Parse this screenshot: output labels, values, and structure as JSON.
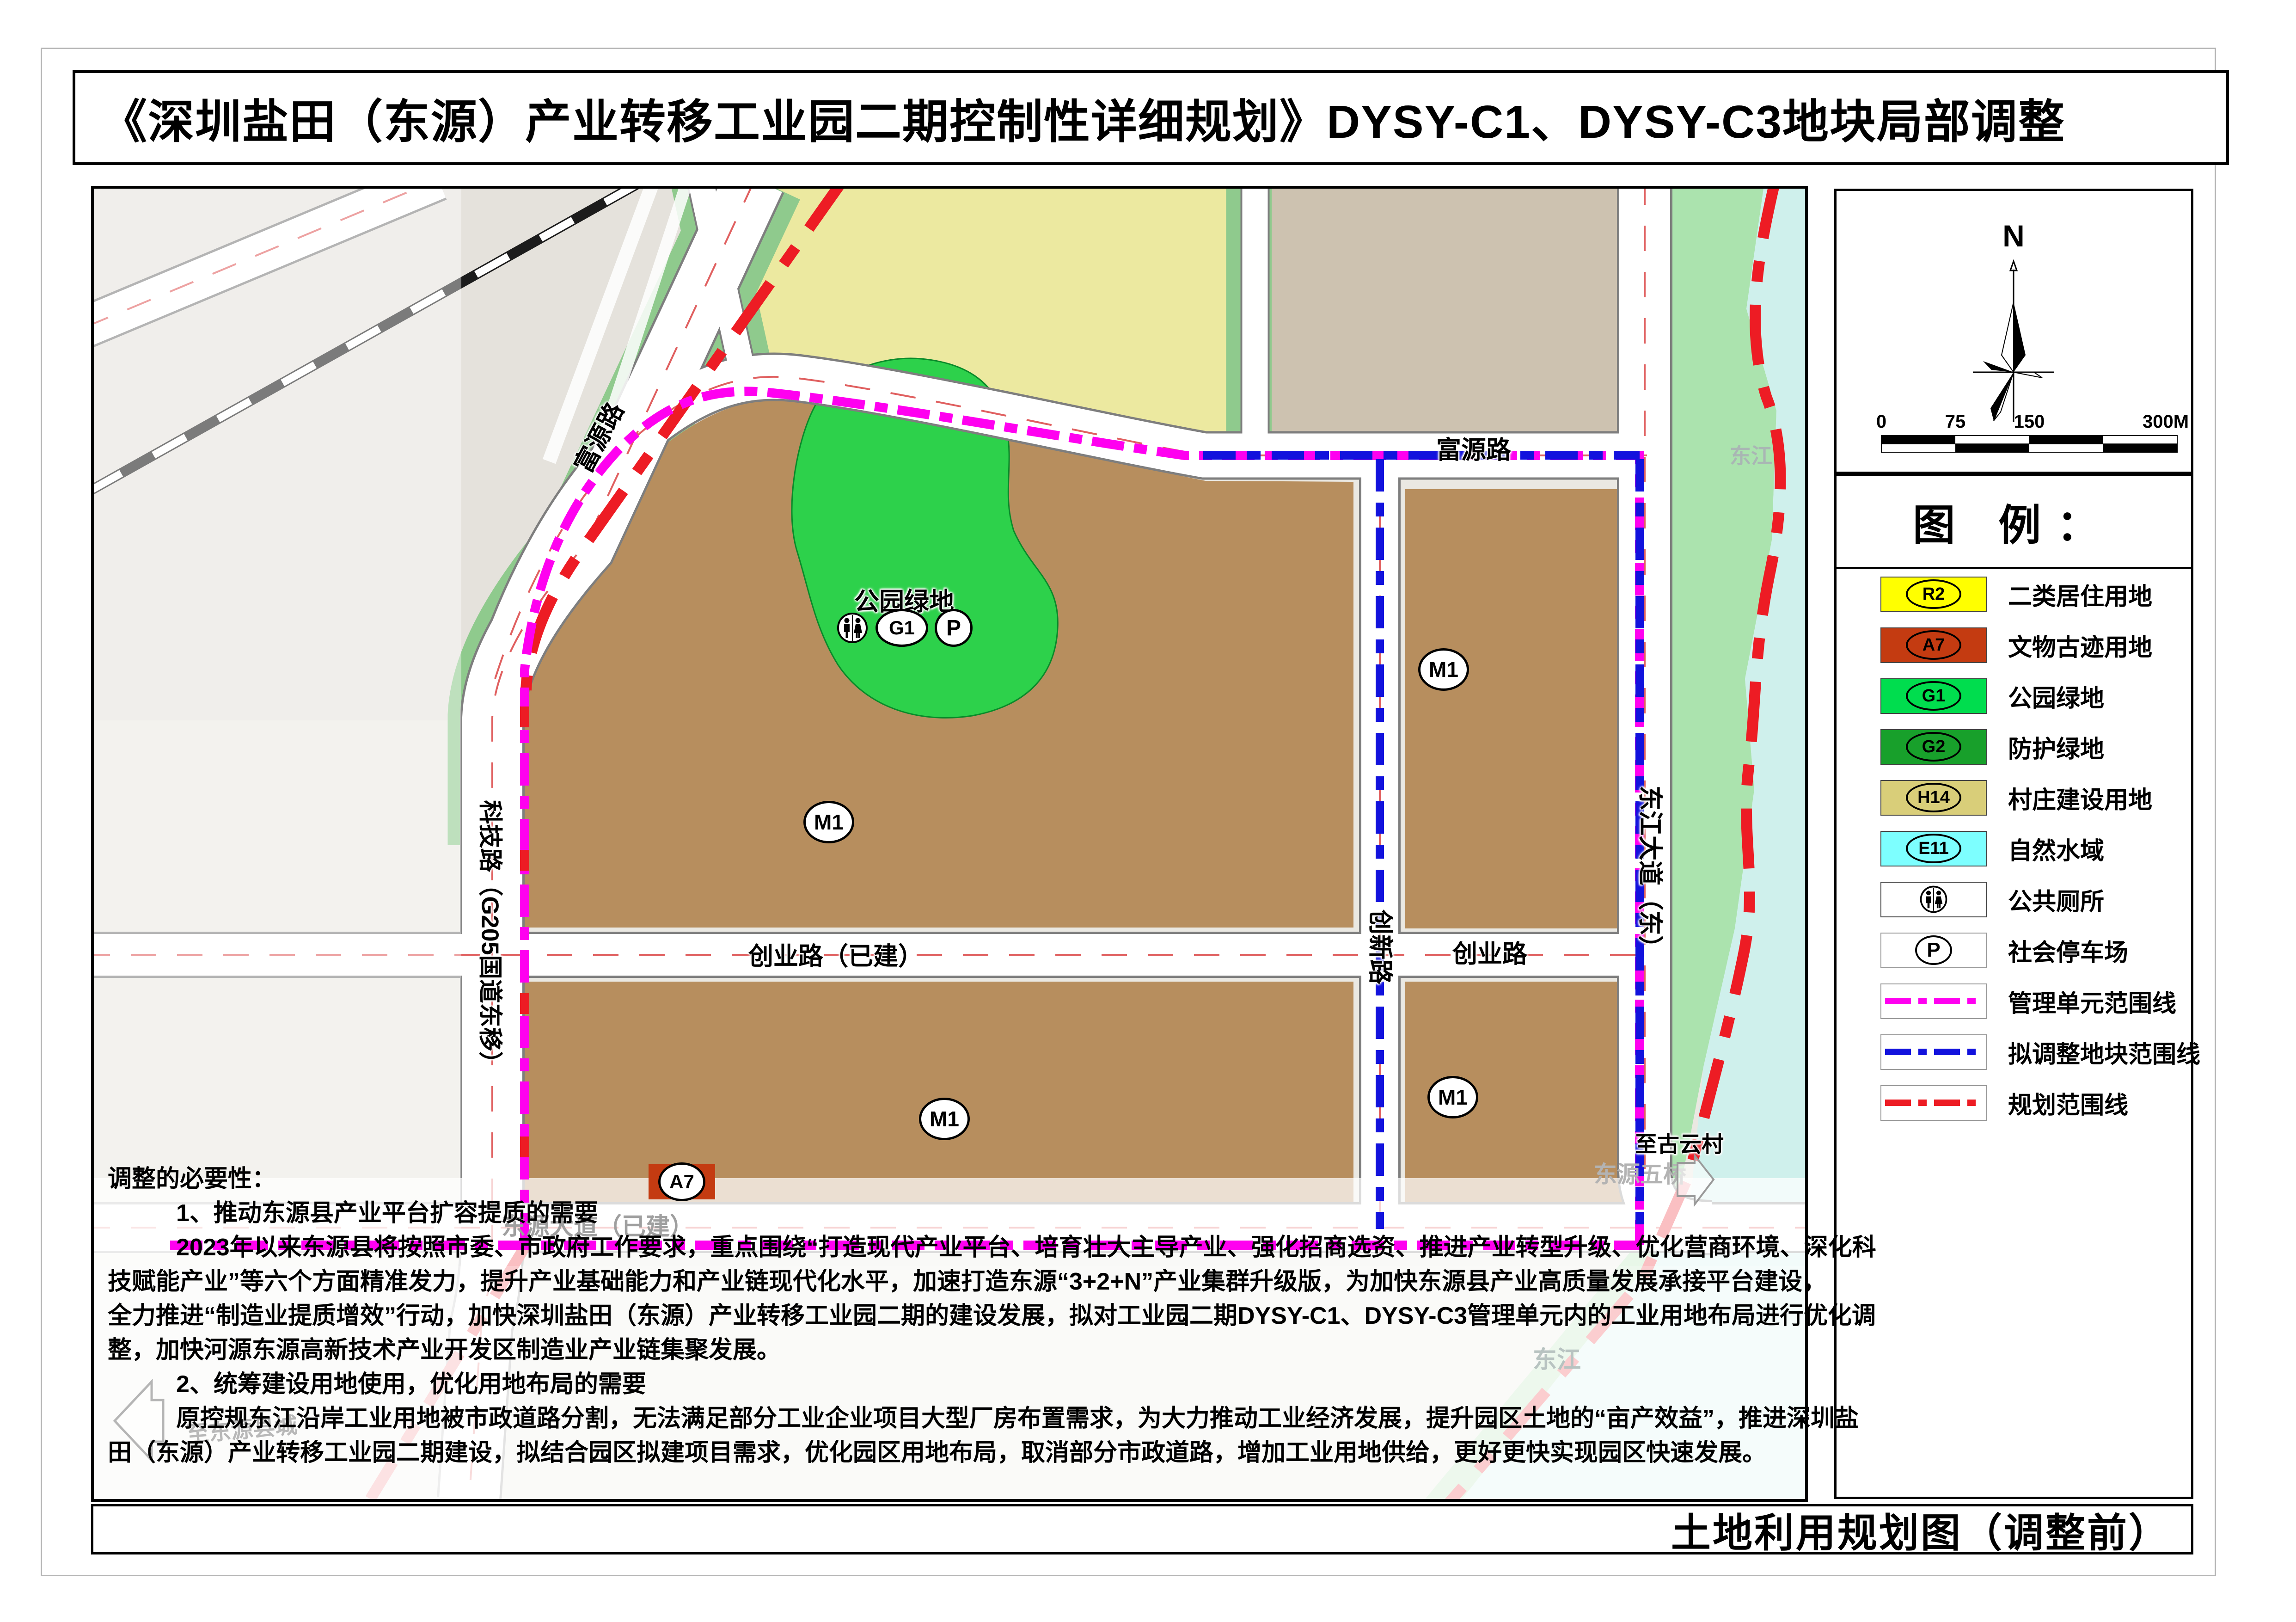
{
  "title": "《深圳盐田（东源）产业转移工业园二期控制性详细规划》DYSY-C1、DYSY-C3地块局部调整",
  "caption": "土地利用规划图（调整前）",
  "compass": {
    "north": "N"
  },
  "scale": {
    "t0": "0",
    "t1": "75",
    "t2": "150",
    "t3": "300M"
  },
  "legend": {
    "title": "图  例：",
    "items": [
      {
        "code": "R2",
        "label": "二类居住用地",
        "color": "#ffff00",
        "kind": "area"
      },
      {
        "code": "A7",
        "label": "文物古迹用地",
        "color": "#c43b11",
        "kind": "area"
      },
      {
        "code": "G1",
        "label": "公园绿地",
        "color": "#00dd4e",
        "kind": "area"
      },
      {
        "code": "G2",
        "label": "防护绿地",
        "color": "#18a02b",
        "kind": "area"
      },
      {
        "code": "H14",
        "label": "村庄建设用地",
        "color": "#d9ce79",
        "kind": "area"
      },
      {
        "code": "E11",
        "label": "自然水域",
        "color": "#7dffff",
        "kind": "area"
      },
      {
        "code": "",
        "label": "公共厕所",
        "color": "#ffffff",
        "kind": "toilet"
      },
      {
        "code": "P",
        "label": "社会停车场",
        "color": "#ffffff",
        "kind": "parking"
      },
      {
        "code": "",
        "label": "管理单元范围线",
        "color": "#ff00f0",
        "kind": "line"
      },
      {
        "code": "",
        "label": "拟调整地块范围线",
        "color": "#1212dd",
        "kind": "line"
      },
      {
        "code": "",
        "label": "规划范围线",
        "color": "#ed1c24",
        "kind": "line"
      }
    ]
  },
  "map": {
    "roads": [
      {
        "text": "富源路"
      },
      {
        "text": "富源路"
      },
      {
        "text": "科技路（G205国道东移）"
      },
      {
        "text": "创新路"
      },
      {
        "text": "东江大道（东）"
      },
      {
        "text": "创业路（已建）"
      },
      {
        "text": "创业路"
      },
      {
        "text": "东源大道（已建）"
      }
    ],
    "areas": {
      "park": "公园绿地"
    },
    "badges": {
      "m1": "M1",
      "a7": "A7",
      "g1": "G1",
      "p": "P"
    },
    "places": {
      "guyun": "至古云村",
      "wuqiao": "东源五桥",
      "dongjiang": "东江",
      "xiancheng": "至东源县城"
    }
  },
  "notes": {
    "lines": [
      {
        "text": "调整的必要性："
      },
      {
        "text": "1、推动东源县产业平台扩容提质的需要"
      },
      {
        "text": "2023年以来东源县将按照市委、市政府工作要求，重点围绕“打造现代产业平台、培育壮大主导产业、强化招商选资、推进产业转型升级、优化营商环境、深化科"
      },
      {
        "text": "技赋能产业”等六个方面精准发力，提升产业基础能力和产业链现代化水平，加速打造东源“3+2+N”产业集群升级版，为加快东源县产业高质量发展承接平台建设，"
      },
      {
        "text": "全力推进“制造业提质增效”行动，加快深圳盐田（东源）产业转移工业园二期的建设发展，拟对工业园二期DYSY-C1、DYSY-C3管理单元内的工业用地布局进行优化调"
      },
      {
        "text": "整，加快河源东源高新技术产业开发区制造业产业链集聚发展。"
      },
      {
        "text": "2、统筹建设用地使用，优化用地布局的需要"
      },
      {
        "text": "原控规东江沿岸工业用地被市政道路分割，无法满足部分工业企业项目大型厂房布置需求，为大力推动工业经济发展，提升园区土地的“亩产效益”，推进深圳盐"
      },
      {
        "text": "田（东源）产业转移工业园二期建设，拟结合园区拟建项目需求，优化园区用地布局，取消部分市政道路，增加工业用地供给，更好更快实现园区快速发展。"
      }
    ]
  }
}
